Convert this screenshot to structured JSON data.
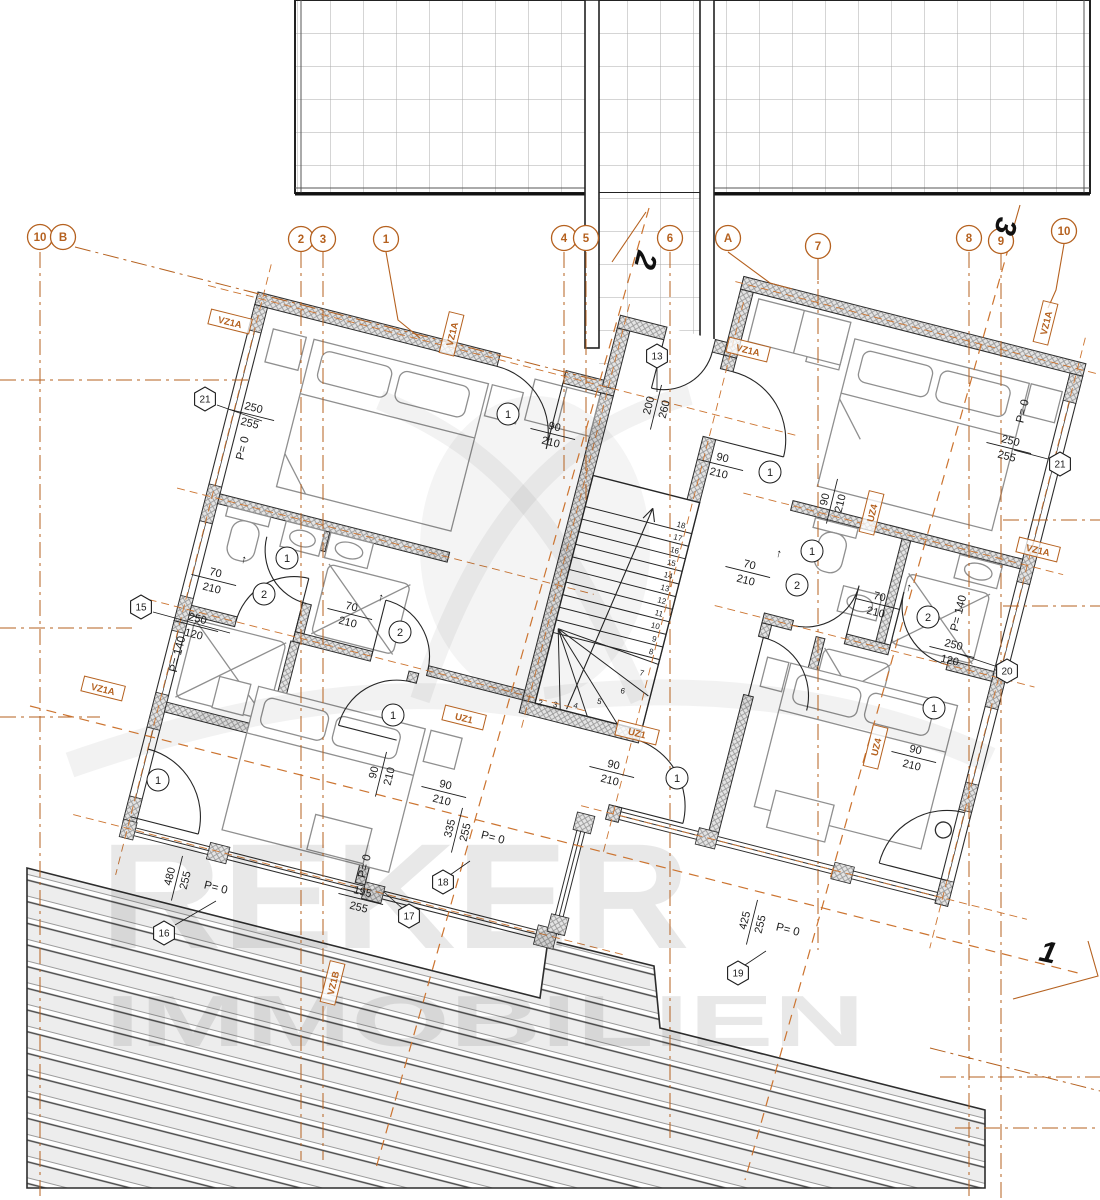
{
  "watermark": {
    "line1": "REKER",
    "line2": "IMMOBILIEN"
  },
  "colors": {
    "axis": "#b5611f",
    "axis_dash": "#cc7430",
    "wall": "#2d2d2d",
    "ink": "#1c1c1c",
    "furniture": "#8f8f8f",
    "grid_line": "#ababab",
    "deck_line": "#4a4a4a",
    "watermark_gray": "#e9e9e9"
  },
  "grid_bubbles": [
    {
      "t": "10",
      "x": 40,
      "y": 237
    },
    {
      "t": "B",
      "x": 63,
      "y": 237
    },
    {
      "t": "2",
      "x": 301,
      "y": 239
    },
    {
      "t": "3",
      "x": 323,
      "y": 239
    },
    {
      "t": "1",
      "x": 386,
      "y": 239
    },
    {
      "t": "4",
      "x": 564,
      "y": 238
    },
    {
      "t": "5",
      "x": 586,
      "y": 238
    },
    {
      "t": "6",
      "x": 670,
      "y": 238
    },
    {
      "t": "A",
      "x": 728,
      "y": 238
    },
    {
      "t": "7",
      "x": 818,
      "y": 246
    },
    {
      "t": "8",
      "x": 969,
      "y": 238
    },
    {
      "t": "9",
      "x": 1001,
      "y": 241
    },
    {
      "t": "10",
      "x": 1064,
      "y": 231
    }
  ],
  "section_markers": [
    {
      "t": "2",
      "x": 636,
      "y": 258,
      "rot": 104
    },
    {
      "t": "3",
      "x": 996,
      "y": 224,
      "rot": 104
    },
    {
      "t": "1",
      "x": 1046,
      "y": 962,
      "rot": 12
    }
  ],
  "hex_markers": [
    {
      "t": "13",
      "x": 657,
      "y": 356
    },
    {
      "t": "21",
      "x": 205,
      "y": 399
    },
    {
      "t": "21",
      "x": 1060,
      "y": 464
    },
    {
      "t": "15",
      "x": 141,
      "y": 607
    },
    {
      "t": "20",
      "x": 1007,
      "y": 671
    },
    {
      "t": "16",
      "x": 164,
      "y": 933
    },
    {
      "t": "17",
      "x": 409,
      "y": 916
    },
    {
      "t": "18",
      "x": 443,
      "y": 882
    },
    {
      "t": "19",
      "x": 738,
      "y": 973
    }
  ],
  "box_labels": [
    {
      "t": "VZ1A",
      "x": 230,
      "y": 322,
      "rot": 14
    },
    {
      "t": "VZ1A",
      "x": 452,
      "y": 334,
      "rot": -76
    },
    {
      "t": "VZ1A",
      "x": 748,
      "y": 350,
      "rot": 14
    },
    {
      "t": "VZ1A",
      "x": 1046,
      "y": 323,
      "rot": -76
    },
    {
      "t": "VZ1A",
      "x": 1038,
      "y": 550,
      "rot": 14
    },
    {
      "t": "VZ1A",
      "x": 103,
      "y": 689,
      "rot": 14
    },
    {
      "t": "VZ1B",
      "x": 333,
      "y": 983,
      "rot": -76
    },
    {
      "t": "UZ1",
      "x": 464,
      "y": 718,
      "rot": 14
    },
    {
      "t": "UZ1",
      "x": 637,
      "y": 733,
      "rot": 14
    },
    {
      "t": "UZ4",
      "x": 872,
      "y": 513,
      "rot": -76
    },
    {
      "t": "UZ4",
      "x": 876,
      "y": 747,
      "rot": -76
    }
  ],
  "dim_labels": [
    {
      "a": "250",
      "b": "255",
      "x": 252,
      "y": 414,
      "rot": 14
    },
    {
      "a": "90",
      "b": "210",
      "x": 553,
      "y": 433,
      "rot": 14
    },
    {
      "a": "200",
      "b": "260",
      "x": 655,
      "y": 407,
      "rot": -76
    },
    {
      "a": "90",
      "b": "210",
      "x": 721,
      "y": 464,
      "rot": 14
    },
    {
      "a": "250",
      "b": "255",
      "x": 1009,
      "y": 447,
      "rot": 14
    },
    {
      "a": "90",
      "b": "210",
      "x": 831,
      "y": 501,
      "rot": -76
    },
    {
      "a": "70",
      "b": "210",
      "x": 214,
      "y": 579,
      "rot": 14
    },
    {
      "a": "70",
      "b": "210",
      "x": 350,
      "y": 613,
      "rot": 14
    },
    {
      "a": "70",
      "b": "210",
      "x": 748,
      "y": 571,
      "rot": 14
    },
    {
      "a": "70",
      "b": "210",
      "x": 878,
      "y": 603,
      "rot": 14
    },
    {
      "a": "250",
      "b": "120",
      "x": 196,
      "y": 625,
      "rot": 14
    },
    {
      "a": "250",
      "b": "120",
      "x": 952,
      "y": 651,
      "rot": 14
    },
    {
      "a": "90",
      "b": "210",
      "x": 380,
      "y": 774,
      "rot": -76
    },
    {
      "a": "90",
      "b": "210",
      "x": 444,
      "y": 791,
      "rot": 14
    },
    {
      "a": "90",
      "b": "210",
      "x": 612,
      "y": 771,
      "rot": 14
    },
    {
      "a": "90",
      "b": "210",
      "x": 914,
      "y": 756,
      "rot": 14
    },
    {
      "a": "480",
      "b": "255",
      "x": 176,
      "y": 878,
      "rot": -76
    },
    {
      "a": "195",
      "b": "255",
      "x": 361,
      "y": 898,
      "rot": 14
    },
    {
      "a": "335",
      "b": "255",
      "x": 456,
      "y": 830,
      "rot": -76
    },
    {
      "a": "425",
      "b": "255",
      "x": 751,
      "y": 922,
      "rot": -76
    }
  ],
  "texts": [
    {
      "t": "P= 0",
      "x": 246,
      "y": 449,
      "rot": -76
    },
    {
      "t": "P= 0",
      "x": 1026,
      "y": 412,
      "rot": -76
    },
    {
      "t": "P= 140",
      "x": 181,
      "y": 655,
      "rot": -76
    },
    {
      "t": "P= 140",
      "x": 962,
      "y": 614,
      "rot": -76
    },
    {
      "t": "P= 0",
      "x": 215,
      "y": 891,
      "rot": 14
    },
    {
      "t": "P= 0",
      "x": 368,
      "y": 867,
      "rot": -76
    },
    {
      "t": "P= 0",
      "x": 492,
      "y": 841,
      "rot": 14
    },
    {
      "t": "P= 0",
      "x": 787,
      "y": 933,
      "rot": 14
    },
    {
      "t": "↑",
      "x": 243,
      "y": 563,
      "rot": 14
    },
    {
      "t": "↑",
      "x": 380,
      "y": 601,
      "rot": 14
    },
    {
      "t": "↑",
      "x": 778,
      "y": 557,
      "rot": 14
    },
    {
      "t": "↑",
      "x": 908,
      "y": 591,
      "rot": 14
    }
  ],
  "door_tags": [
    {
      "t": "1",
      "x": 508,
      "y": 414
    },
    {
      "t": "1",
      "x": 770,
      "y": 472
    },
    {
      "t": "1",
      "x": 287,
      "y": 558
    },
    {
      "t": "1",
      "x": 812,
      "y": 551
    },
    {
      "t": "2",
      "x": 264,
      "y": 594
    },
    {
      "t": "2",
      "x": 400,
      "y": 632
    },
    {
      "t": "2",
      "x": 797,
      "y": 585
    },
    {
      "t": "2",
      "x": 928,
      "y": 617
    },
    {
      "t": "1",
      "x": 393,
      "y": 715
    },
    {
      "t": "1",
      "x": 158,
      "y": 780
    },
    {
      "t": "1",
      "x": 677,
      "y": 778
    },
    {
      "t": "1",
      "x": 934,
      "y": 708
    }
  ],
  "stair_numbers": {
    "straight": [
      {
        "n": "18",
        "x": 472,
        "y": 124
      },
      {
        "n": "17",
        "x": 472,
        "y": 137
      },
      {
        "n": "16",
        "x": 472,
        "y": 150
      },
      {
        "n": "15",
        "x": 472,
        "y": 163
      },
      {
        "n": "14",
        "x": 472,
        "y": 176
      },
      {
        "n": "13",
        "x": 472,
        "y": 189
      },
      {
        "n": "12",
        "x": 472,
        "y": 202
      },
      {
        "n": "11",
        "x": 472,
        "y": 215
      },
      {
        "n": "10",
        "x": 472,
        "y": 228
      },
      {
        "n": "9",
        "x": 472,
        "y": 241
      },
      {
        "n": "8",
        "x": 472,
        "y": 254
      }
    ],
    "winder": [
      {
        "n": "7",
        "x": 466,
        "y": 277
      },
      {
        "n": "6",
        "x": 452,
        "y": 299
      },
      {
        "n": "5",
        "x": 432,
        "y": 315
      },
      {
        "n": "4",
        "x": 410,
        "y": 325
      },
      {
        "n": "3",
        "x": 390,
        "y": 329
      },
      {
        "n": "2",
        "x": 375,
        "y": 331
      }
    ]
  }
}
